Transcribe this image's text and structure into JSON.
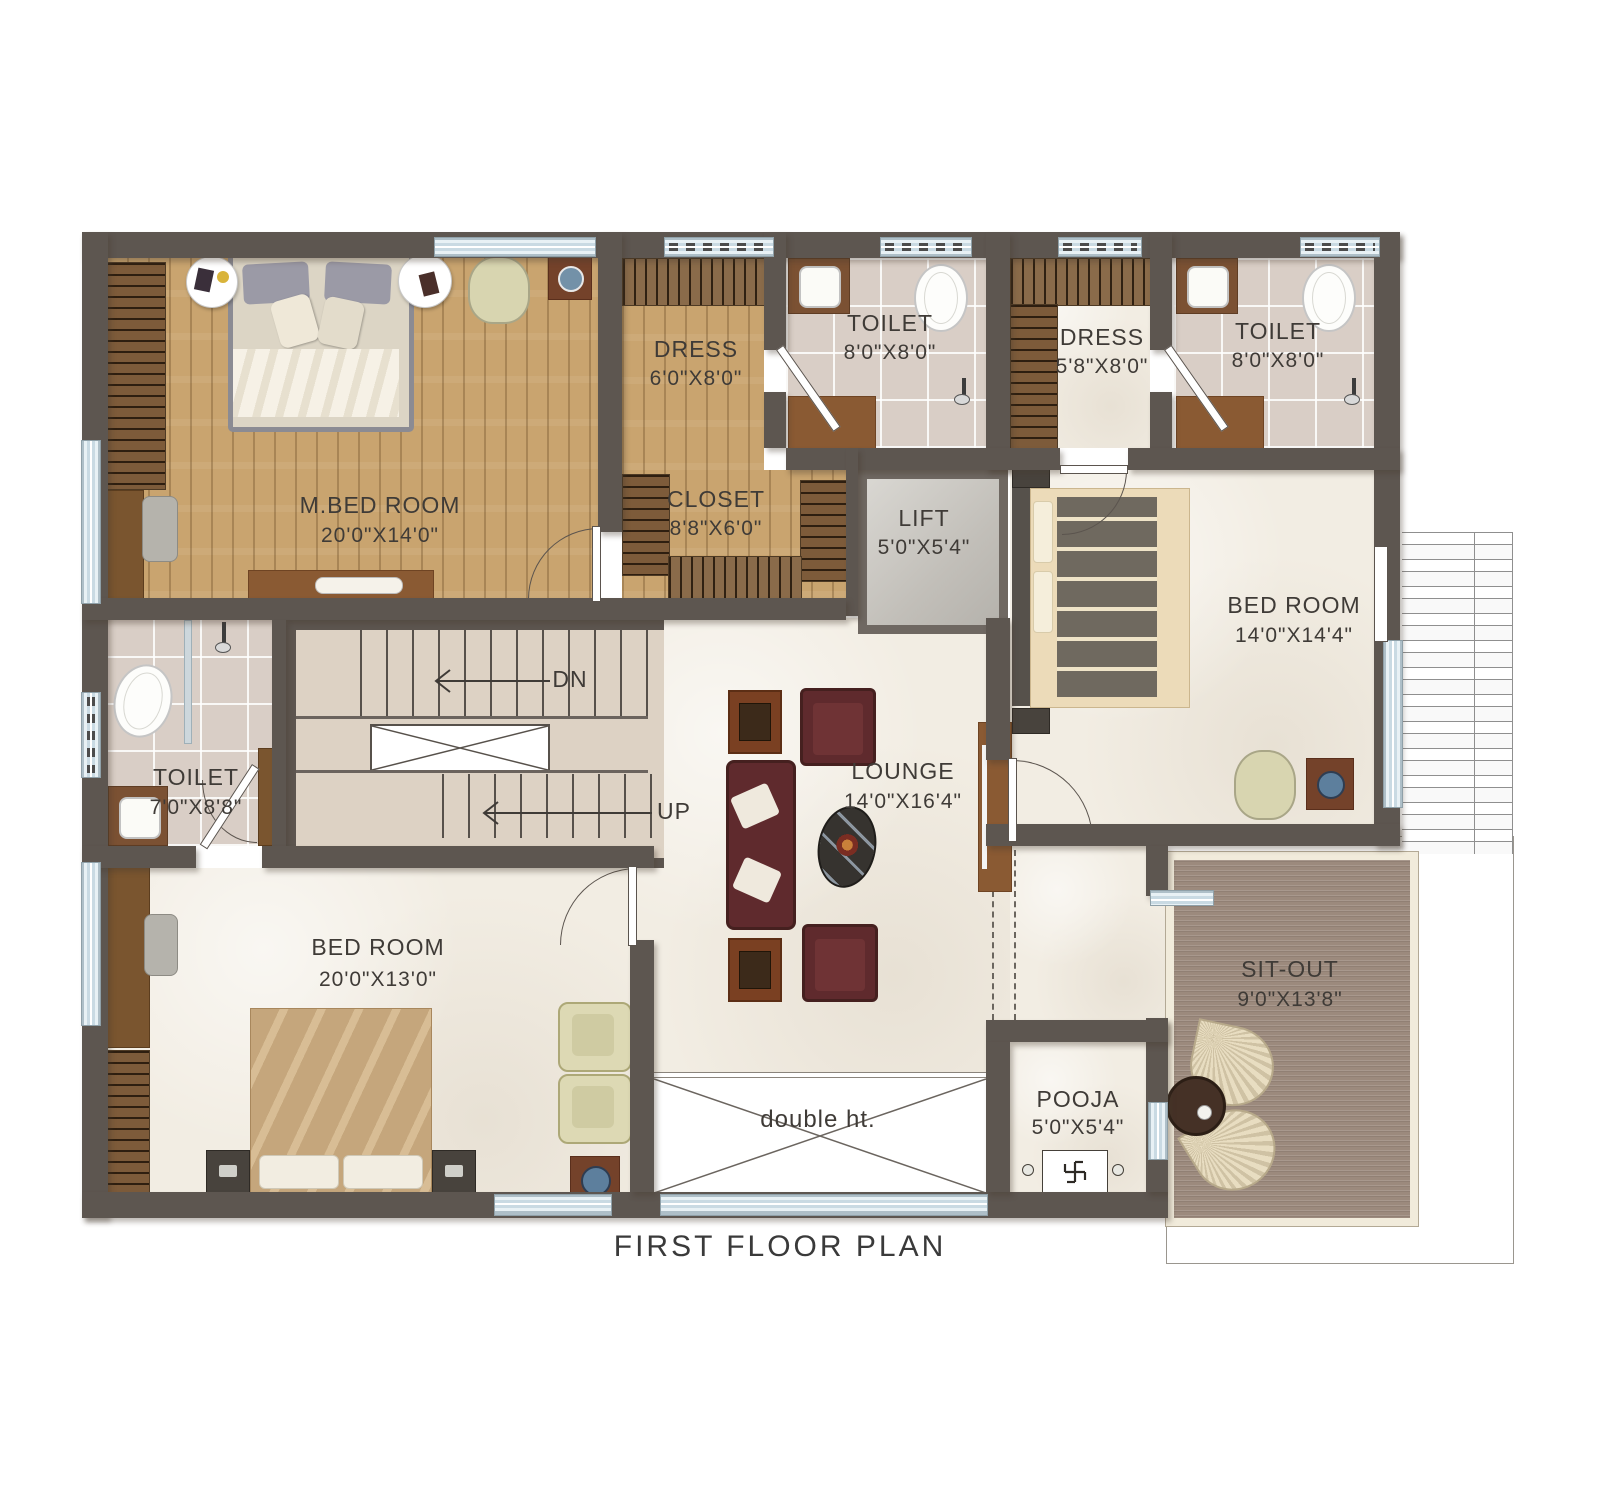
{
  "title": "FIRST FLOOR PLAN",
  "rooms": {
    "m_bed_room": {
      "name": "M.BED ROOM",
      "dims": "20'0\"X14'0\""
    },
    "dress_1": {
      "name": "DRESS",
      "dims": "6'0\"X8'0\""
    },
    "toilet_1": {
      "name": "TOILET",
      "dims": "8'0\"X8'0\""
    },
    "dress_2": {
      "name": "DRESS",
      "dims": "5'8\"X8'0\""
    },
    "toilet_2": {
      "name": "TOILET",
      "dims": "8'0\"X8'0\""
    },
    "closet": {
      "name": "CLOSET",
      "dims": "8'8\"X6'0\""
    },
    "lift": {
      "name": "LIFT",
      "dims": "5'0\"X5'4\""
    },
    "bed_room_right": {
      "name": "BED ROOM",
      "dims": "14'0\"X14'4\""
    },
    "toilet_3": {
      "name": "TOILET",
      "dims": "7'0\"X8'8\""
    },
    "lounge": {
      "name": "LOUNGE",
      "dims": "14'0\"X16'4\""
    },
    "bed_room_bottom": {
      "name": "BED ROOM",
      "dims": "20'0\"X13'0\""
    },
    "sit_out": {
      "name": "SIT-OUT",
      "dims": "9'0\"X13'8\""
    },
    "pooja": {
      "name": "POOJA",
      "dims": "5'0\"X5'4\""
    },
    "double_height": {
      "name": "double ht."
    }
  },
  "stairs": {
    "down_label": "DN",
    "up_label": "UP"
  },
  "symbols": {
    "swastika": "swastika"
  },
  "colors": {
    "wall": "#5d5650",
    "wood": "#c9a46f",
    "tile": "#d9cec6",
    "marble": "#f2ede3",
    "deck": "#9c8a7d",
    "deck_border": "#f1ebdb",
    "sofa": "#5f2a2d",
    "cabinet": "#8a5a33",
    "window": "#d5e3ea",
    "label": "#3f3b37"
  }
}
